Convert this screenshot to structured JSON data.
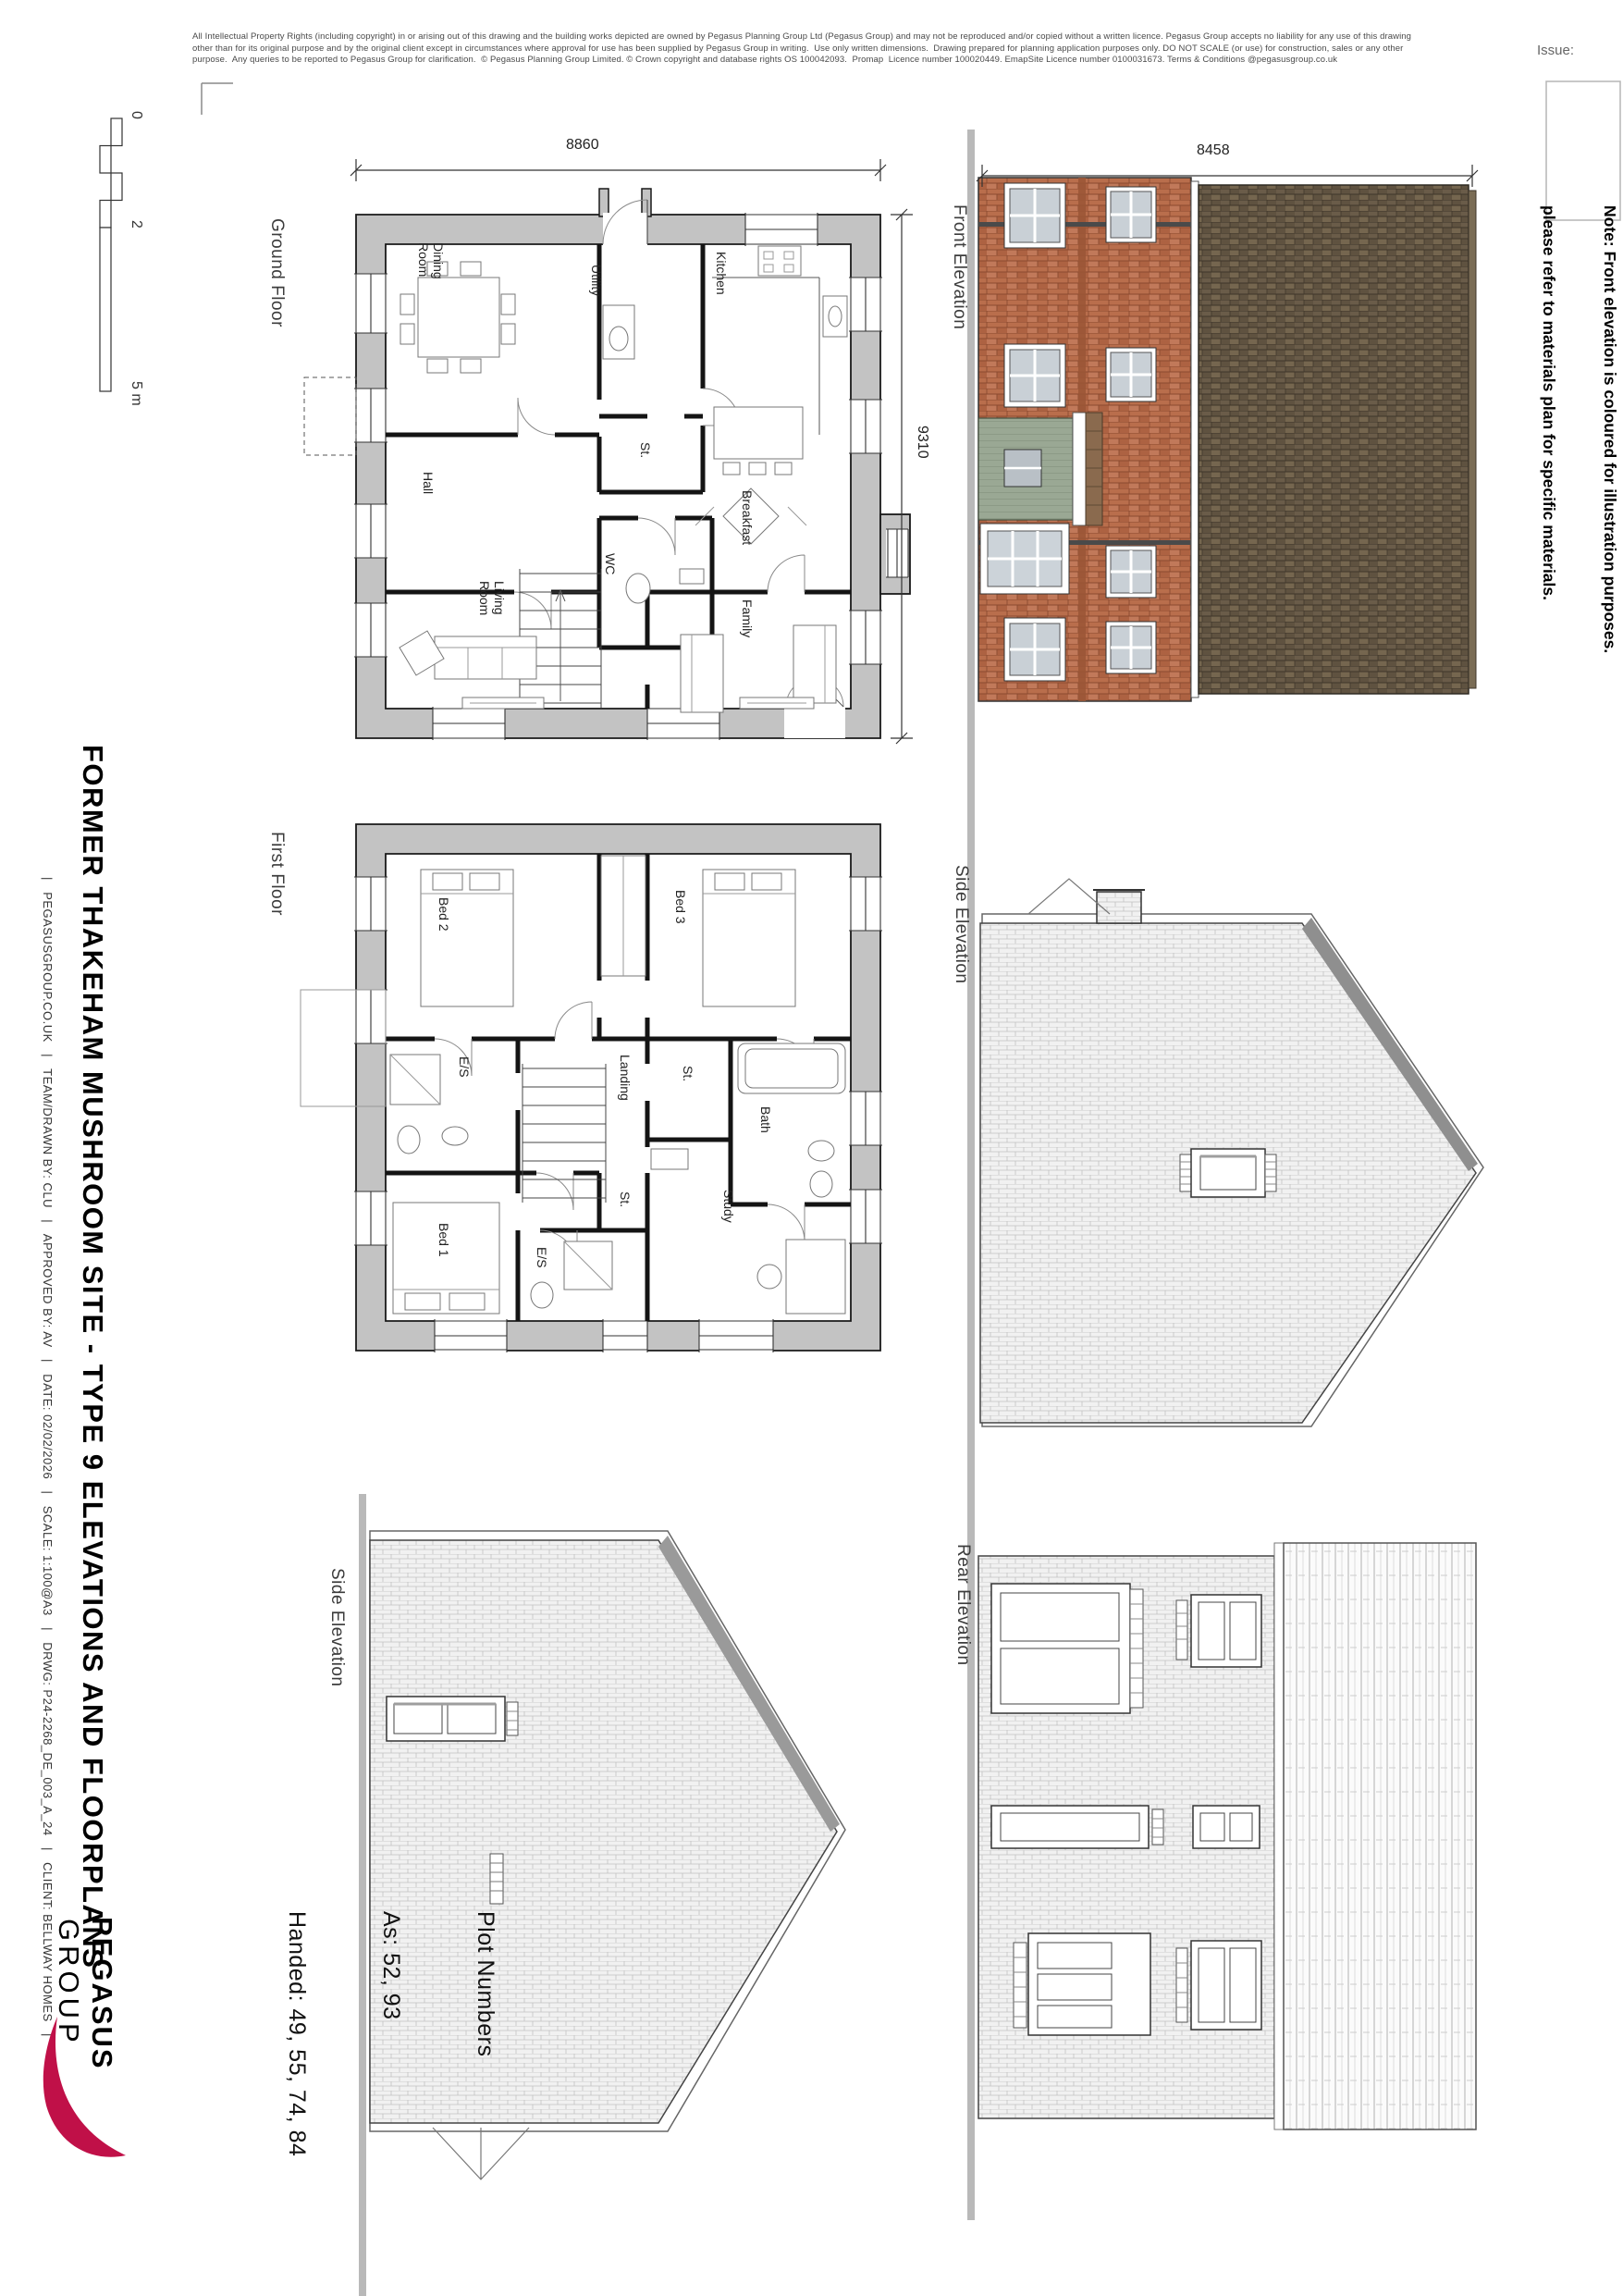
{
  "sheet": {
    "issue_label": "Issue:"
  },
  "disclaimer": {
    "line1": "All Intellectual Property Rights (including copyright) in or arising out of this drawing and the building works depicted are owned by Pegasus Planning Group Ltd (Pegasus Group) and may not be reproduced and/or copied without a written licence. Pegasus Group accepts no liability for any use of this drawing",
    "line2": "other than for its original purpose and by the original client except in circumstances where approval for use has been supplied by Pegasus Group in writing.  Use only written dimensions.  Drawing prepared for planning application purposes only. DO NOT SCALE (or use) for construction, sales or any other",
    "line3": "purpose.  Any queries to be reported to Pegasus Group for clarification.  © Pegasus Planning Group Limited. © Crown copyright and database rights OS 100042093.  Promap  Licence number 100020449. EmapSite Licence number 0100031673. Terms & Conditions @pegasusgroup.co.uk"
  },
  "titleblock": {
    "title": "FORMER THAKEHAM MUSHROOM SITE - TYPE 9 ELEVATIONS AND FLOORPLANS",
    "info_line": "|   PEGASUSGROUP.CO.UK   |   TEAM/DRAWN BY: CLU   |   APPROVED BY: AV   |   DATE: 02/02/2026   |   SCALE: 1:100@A3   |   DRWG: P24-2268_DE_003_A_24   |   CLIENT: BELLWAY HOMES   |"
  },
  "logo": {
    "line1": "PEGASUS",
    "line2": "GROUP"
  },
  "plot_numbers": {
    "heading": "Plot Numbers",
    "as_line": "As: 52, 93",
    "handed_line": "Handed: 49, 55, 74, 84"
  },
  "note": {
    "line1": "Note: Front elevation is coloured for illustration purposes.",
    "line2": "please refer to materials plan for specific materials."
  },
  "scale_bar": {
    "zero": "0",
    "two": "2",
    "five": "5 m"
  },
  "ground_floor": {
    "label": "Ground Floor",
    "dim_width": "8860",
    "dim_height": "9310",
    "rooms": {
      "dining": "Dining\nRoom",
      "utility": "Utility",
      "kitchen": "Kitchen",
      "store": "St.",
      "hall": "Hall",
      "wc": "WC",
      "breakfast": "Breakfast",
      "living": "Living\nRoom",
      "family": "Family"
    }
  },
  "first_floor": {
    "label": "First Floor",
    "rooms": {
      "bed2": "Bed 2",
      "bed3": "Bed 3",
      "es_top": "E/S",
      "store_top": "St.",
      "landing": "Landing",
      "bath": "Bath",
      "bed1": "Bed 1",
      "store_mid": "St.",
      "es_bottom": "E/S",
      "study": "Study"
    }
  },
  "elevations": {
    "front": {
      "label": "Front Elevation",
      "dim_width": "8458"
    },
    "side_upper": {
      "label": "Side Elevation"
    },
    "rear": {
      "label": "Rear Elevation"
    },
    "side_lower": {
      "label": "Side Elevation"
    }
  },
  "colors": {
    "brick_red": "#b96e4c",
    "roof_dark": "#60523f",
    "porch_sage": "#9aa894",
    "logo_accent": "#c01048",
    "plan_wall_grey": "#c3c3c3",
    "hatch_grey": "#c2c2c2"
  }
}
